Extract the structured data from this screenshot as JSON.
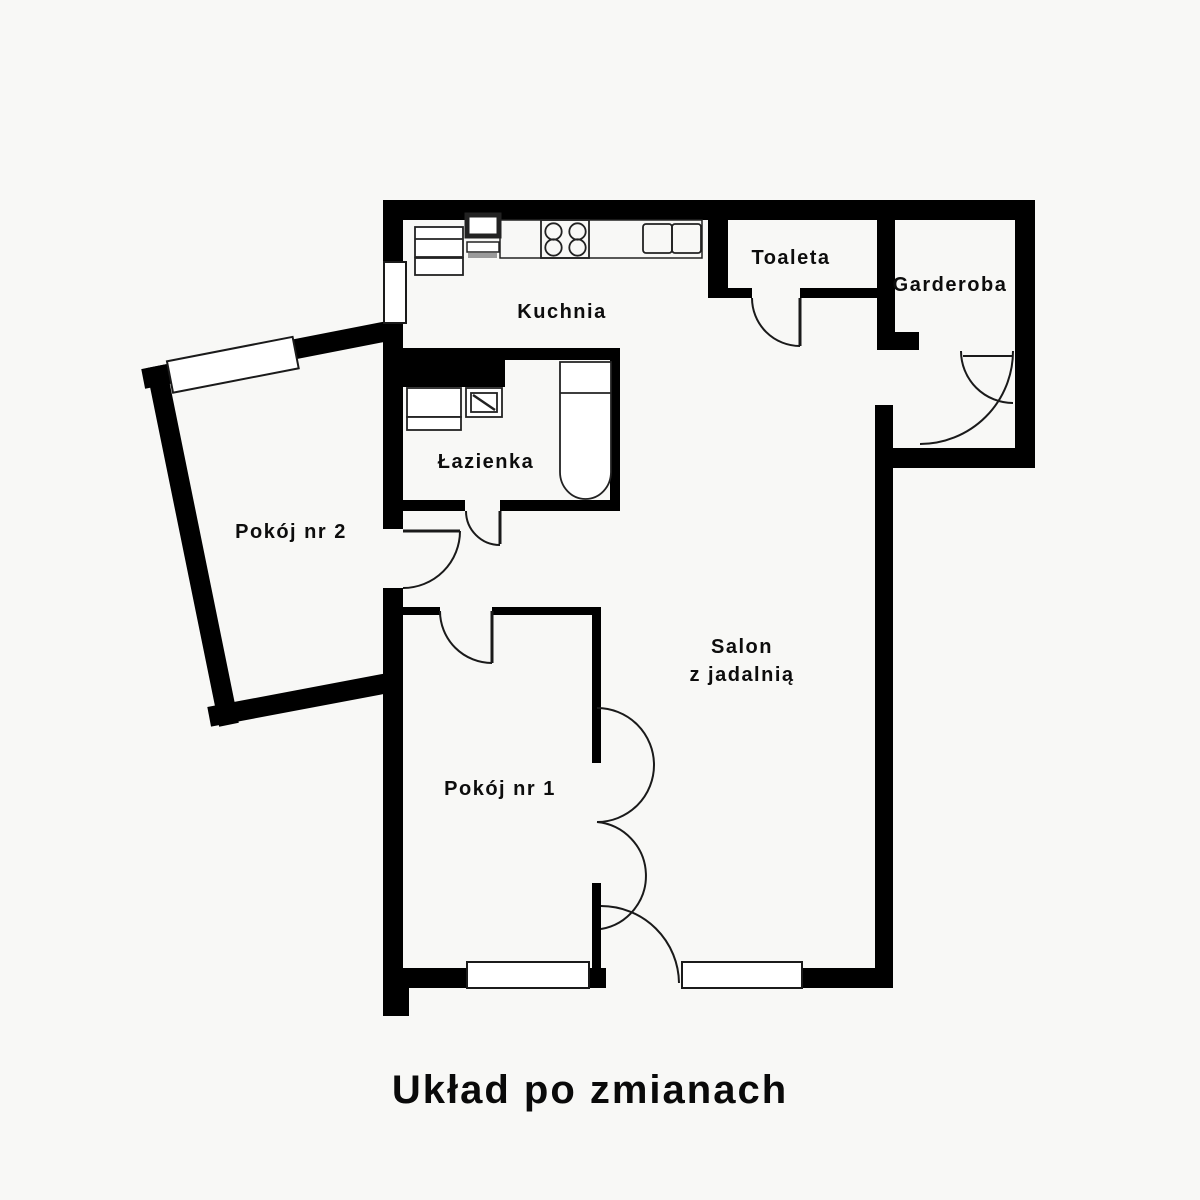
{
  "title": "Układ po zmianach",
  "colors": {
    "wall": "#000000",
    "background": "#f8f8f6",
    "line_dark": "#1a1a1a",
    "text": "#0d0d0d"
  },
  "rooms": {
    "kuchnia": {
      "label": "Kuchnia"
    },
    "toaleta": {
      "label": "Toaleta"
    },
    "garderoba": {
      "label": "Garderoba"
    },
    "lazienka": {
      "label": "Łazienka"
    },
    "pokoj2": {
      "label": "Pokój nr 2"
    },
    "pokoj1": {
      "label": "Pokój nr 1"
    },
    "salon": {
      "line1": "Salon",
      "line2": "z jadalnią"
    }
  },
  "fixture_icons": [
    "fridge-icon",
    "kitchen-cabinet-icon",
    "stove-icon",
    "kitchen-sink-icon",
    "washing-machine-icon",
    "bathroom-sink-icon",
    "bathtub-icon"
  ],
  "window_count": 4,
  "door_count": 7
}
